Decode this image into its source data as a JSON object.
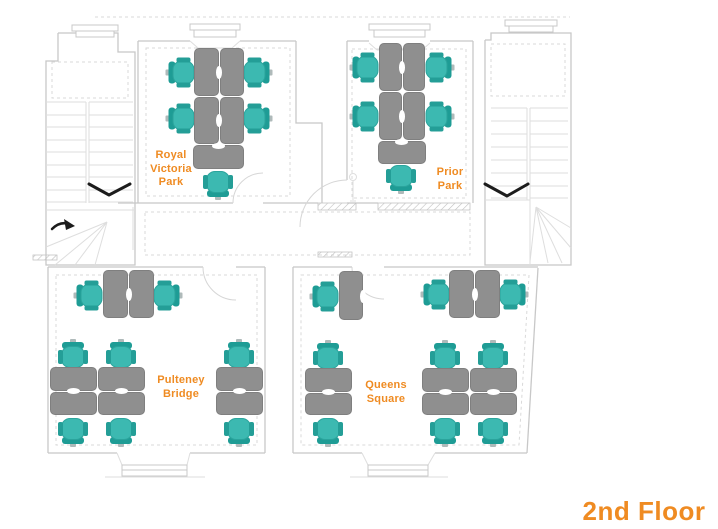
{
  "floor_title": "2nd Floor",
  "colors": {
    "accent_orange": "#ef8b22",
    "chair_seat": "#3cb9b1",
    "chair_back": "#1e9c95",
    "desk_gray": "#8f8f8f",
    "wall_gray": "#c8c8c8",
    "arrow_black": "#1c1c1c"
  },
  "icons": {
    "stair_direction_arrows": "down-chevron-icon",
    "winder_turn_arrow": "curved-arrow-icon",
    "floor_lamp": "floor-lamp-icon"
  },
  "rooms": [
    {
      "id": "royal-victoria-park",
      "label": "Royal\nVictoria\nPark"
    },
    {
      "id": "prior-park",
      "label": "Prior\nPark"
    },
    {
      "id": "pulteney-bridge",
      "label": "Pulteney\nBridge"
    },
    {
      "id": "queens-square",
      "label": "Queens\nSquare"
    }
  ],
  "desks": [
    {
      "room": "royal-victoria-park",
      "x": 194,
      "y": 48,
      "w": 25,
      "h": 48
    },
    {
      "room": "royal-victoria-park",
      "x": 220,
      "y": 48,
      "w": 24,
      "h": 48
    },
    {
      "room": "royal-victoria-park",
      "x": 194,
      "y": 97,
      "w": 25,
      "h": 47
    },
    {
      "room": "royal-victoria-park",
      "x": 220,
      "y": 97,
      "w": 24,
      "h": 47
    },
    {
      "room": "royal-victoria-park",
      "x": 193,
      "y": 145,
      "w": 51,
      "h": 24
    },
    {
      "room": "prior-park",
      "x": 379,
      "y": 43,
      "w": 23,
      "h": 48
    },
    {
      "room": "prior-park",
      "x": 403,
      "y": 43,
      "w": 22,
      "h": 48
    },
    {
      "room": "prior-park",
      "x": 379,
      "y": 92,
      "w": 23,
      "h": 48
    },
    {
      "room": "prior-park",
      "x": 403,
      "y": 92,
      "w": 22,
      "h": 48
    },
    {
      "room": "prior-park",
      "x": 378,
      "y": 141,
      "w": 48,
      "h": 23
    },
    {
      "room": "pulteney-bridge",
      "x": 103,
      "y": 270,
      "w": 25,
      "h": 48
    },
    {
      "room": "pulteney-bridge",
      "x": 129,
      "y": 270,
      "w": 25,
      "h": 48
    },
    {
      "room": "pulteney-bridge",
      "x": 50,
      "y": 367,
      "w": 47,
      "h": 24
    },
    {
      "room": "pulteney-bridge",
      "x": 98,
      "y": 367,
      "w": 47,
      "h": 24
    },
    {
      "room": "pulteney-bridge",
      "x": 50,
      "y": 392,
      "w": 47,
      "h": 23
    },
    {
      "room": "pulteney-bridge",
      "x": 98,
      "y": 392,
      "w": 47,
      "h": 23
    },
    {
      "room": "pulteney-bridge",
      "x": 216,
      "y": 367,
      "w": 47,
      "h": 24
    },
    {
      "room": "pulteney-bridge",
      "x": 216,
      "y": 392,
      "w": 47,
      "h": 23
    },
    {
      "room": "queens-square",
      "x": 339,
      "y": 271,
      "w": 24,
      "h": 49
    },
    {
      "room": "queens-square",
      "x": 449,
      "y": 270,
      "w": 25,
      "h": 48
    },
    {
      "room": "queens-square",
      "x": 475,
      "y": 270,
      "w": 25,
      "h": 48
    },
    {
      "room": "queens-square",
      "x": 305,
      "y": 368,
      "w": 47,
      "h": 24
    },
    {
      "room": "queens-square",
      "x": 305,
      "y": 393,
      "w": 47,
      "h": 22
    },
    {
      "room": "queens-square",
      "x": 422,
      "y": 368,
      "w": 47,
      "h": 24
    },
    {
      "room": "queens-square",
      "x": 470,
      "y": 368,
      "w": 47,
      "h": 24
    },
    {
      "room": "queens-square",
      "x": 422,
      "y": 393,
      "w": 47,
      "h": 22
    },
    {
      "room": "queens-square",
      "x": 470,
      "y": 393,
      "w": 47,
      "h": 22
    }
  ],
  "grommets": [
    {
      "x": 219,
      "y": 72,
      "o": "v"
    },
    {
      "x": 219,
      "y": 120,
      "o": "v"
    },
    {
      "x": 218,
      "y": 146,
      "o": "h"
    },
    {
      "x": 402,
      "y": 67,
      "o": "v"
    },
    {
      "x": 402,
      "y": 116,
      "o": "v"
    },
    {
      "x": 401,
      "y": 142,
      "o": "h"
    },
    {
      "x": 129,
      "y": 294,
      "o": "v"
    },
    {
      "x": 73,
      "y": 391,
      "o": "h"
    },
    {
      "x": 121,
      "y": 391,
      "o": "h"
    },
    {
      "x": 239,
      "y": 391,
      "o": "h"
    },
    {
      "x": 363,
      "y": 296,
      "o": "v"
    },
    {
      "x": 475,
      "y": 294,
      "o": "v"
    },
    {
      "x": 328,
      "y": 392,
      "o": "h"
    },
    {
      "x": 445,
      "y": 392,
      "o": "h"
    },
    {
      "x": 493,
      "y": 392,
      "o": "h"
    }
  ],
  "chairs": [
    {
      "x": 181,
      "y": 72,
      "f": "right"
    },
    {
      "x": 181,
      "y": 118,
      "f": "right"
    },
    {
      "x": 257,
      "y": 72,
      "f": "left"
    },
    {
      "x": 257,
      "y": 118,
      "f": "left"
    },
    {
      "x": 218,
      "y": 184,
      "f": "up"
    },
    {
      "x": 365,
      "y": 67,
      "f": "right"
    },
    {
      "x": 365,
      "y": 116,
      "f": "right"
    },
    {
      "x": 439,
      "y": 67,
      "f": "left"
    },
    {
      "x": 439,
      "y": 116,
      "f": "left"
    },
    {
      "x": 401,
      "y": 178,
      "f": "up"
    },
    {
      "x": 89,
      "y": 295,
      "f": "right"
    },
    {
      "x": 167,
      "y": 295,
      "f": "left"
    },
    {
      "x": 73,
      "y": 354,
      "f": "down"
    },
    {
      "x": 121,
      "y": 354,
      "f": "down"
    },
    {
      "x": 73,
      "y": 431,
      "f": "up"
    },
    {
      "x": 121,
      "y": 431,
      "f": "up"
    },
    {
      "x": 239,
      "y": 354,
      "f": "down"
    },
    {
      "x": 239,
      "y": 431,
      "f": "up"
    },
    {
      "x": 325,
      "y": 296,
      "f": "right"
    },
    {
      "x": 436,
      "y": 294,
      "f": "right"
    },
    {
      "x": 513,
      "y": 294,
      "f": "left"
    },
    {
      "x": 328,
      "y": 355,
      "f": "down"
    },
    {
      "x": 328,
      "y": 431,
      "f": "up"
    },
    {
      "x": 445,
      "y": 355,
      "f": "down"
    },
    {
      "x": 493,
      "y": 355,
      "f": "down"
    },
    {
      "x": 445,
      "y": 431,
      "f": "up"
    },
    {
      "x": 493,
      "y": 431,
      "f": "up"
    }
  ]
}
